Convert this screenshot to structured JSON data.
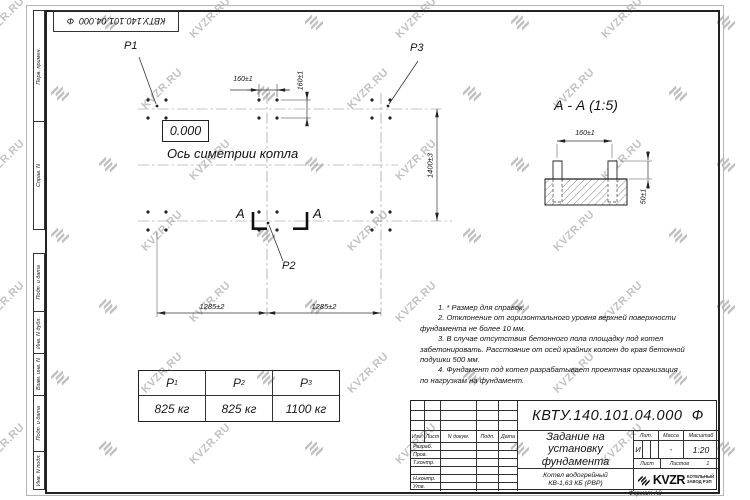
{
  "stamp": {
    "doc_number_top": "КВТУ.140.101.04.000  Ф"
  },
  "watermark": {
    "text": "KVZR.RU"
  },
  "sidebar": {
    "cells_top": [
      "Перв. примен.",
      "Справ. N"
    ],
    "cells_bottom": [
      "Подп. и дата",
      "Инв. N дубл.",
      "Взам. инв. N",
      "Подп. и дата",
      "Инв. N подл."
    ]
  },
  "plan": {
    "p1": "Р1",
    "p2": "Р2",
    "p3": "Р3",
    "elevation": "0.000",
    "axis_label": "Ось симетрии котла",
    "section_letter": "А",
    "dims": {
      "bolt_h": "160±1",
      "bolt_v": "160±1",
      "row_span": "1400±3",
      "col_left": "1285±2",
      "col_right": "1285±2"
    }
  },
  "section_view": {
    "title": "А - А (1:5)",
    "dims": {
      "bolt": "160±1",
      "height": "50±1"
    }
  },
  "notes": {
    "lines": [
      "1.  * Размер для справок.",
      "2.  Отклонение от горизонтального уровня верхней поверхности",
      "фундамента не более 10 мм.",
      "3.  В случае отсутствия бетонного пола площадку под котел",
      "забетонировать. Расстояние от осей крайних колонн до края бетонной",
      "подушки 500 мм.",
      "4.  Фундамент под котел разрабатывает проектная организация",
      "по нагрузкам на фундамент."
    ]
  },
  "load_table": {
    "headers": [
      {
        "b": "Р",
        "s": "1"
      },
      {
        "b": "Р",
        "s": "2"
      },
      {
        "b": "Р",
        "s": "3"
      }
    ],
    "values": [
      "825 кг",
      "825 кг",
      "1100 кг"
    ]
  },
  "title_block": {
    "doc_number": "КВТУ.140.101.04.000  Ф",
    "title_lines": [
      "Задание на",
      "установку",
      "фундамента"
    ],
    "product_lines": [
      "Котел водогрейный",
      "КВ-1,63 КБ (РВР)"
    ],
    "col_headers": [
      "Изм.",
      "Лист",
      "N докум.",
      "Подп.",
      "Дата"
    ],
    "row_labels": [
      "Разраб.",
      "Пров.",
      "Т.контр.",
      "",
      "Н.контр.",
      "Утв."
    ],
    "lit_header": "Лит.",
    "mass_header": "Масса",
    "scale_header": "Масштаб",
    "lit_value": "И",
    "mass_value": "-",
    "scale_value": "1:20",
    "sheet_label": "Лист",
    "sheets_label": "Листов",
    "sheets_value": "1",
    "logo_text": "KVZR",
    "logo_sub": [
      "КОТЕЛЬНЫЙ",
      "ЗАВОД РЭП"
    ],
    "format_label": "Формат А3"
  }
}
